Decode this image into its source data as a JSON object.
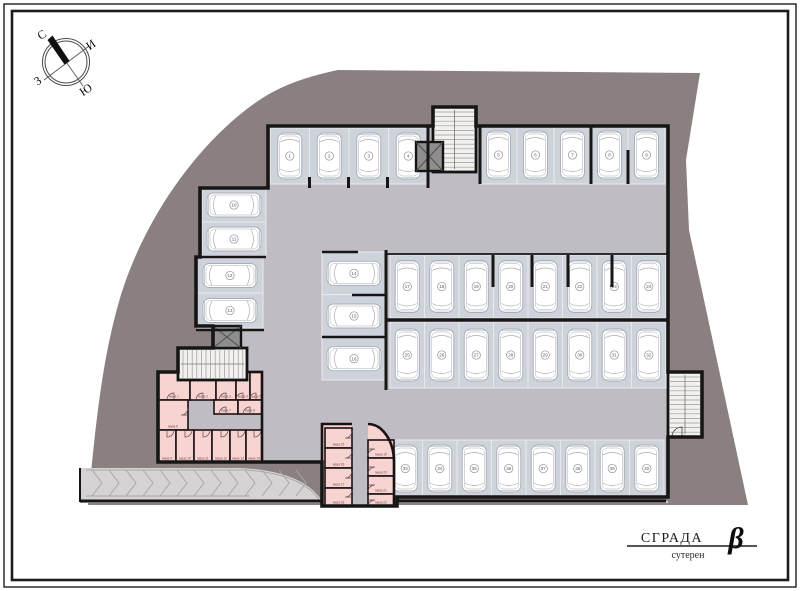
{
  "drawing": {
    "compass": {
      "north": "С",
      "east": "И",
      "west": "З",
      "south": "Ю"
    },
    "title_block": {
      "building_label": "СГРАДА",
      "building_symbol": "β",
      "floor_label": "сутерен"
    },
    "colors": {
      "site": "#8a807f",
      "floor": "#bfbdc3",
      "stall": "#ced2db",
      "road": "#d5d3d4",
      "road_mark": "#a9a7a8",
      "storage": "#f7d3d1",
      "storage_wall": "#1a1212",
      "wall": "#161616",
      "stairs": "#f2f1ef",
      "elevator": "#8f8d8e",
      "car_fill": "#ffffff",
      "car_outline": "#a8adb6",
      "number_ink": "#555b63"
    },
    "parking": {
      "groups": [
        {
          "id": "top-left",
          "numbers": [
            1,
            2,
            3,
            4
          ]
        },
        {
          "id": "top-right",
          "numbers": [
            5,
            6,
            7,
            8,
            9
          ]
        },
        {
          "id": "west-upper",
          "numbers": [
            10,
            11
          ]
        },
        {
          "id": "west-lower",
          "numbers": [
            12,
            13
          ]
        },
        {
          "id": "mid-column",
          "numbers": [
            14,
            15,
            16
          ]
        },
        {
          "id": "center-north",
          "numbers": [
            17,
            18,
            19,
            20,
            21,
            22,
            23,
            24
          ]
        },
        {
          "id": "center-south",
          "numbers": [
            25,
            26,
            27,
            28,
            29,
            30,
            31,
            32
          ]
        },
        {
          "id": "south-row",
          "numbers": [
            33,
            34,
            35,
            36,
            37,
            38,
            39,
            40
          ]
        }
      ]
    },
    "storage": {
      "block1_rooms": [
        "маза 1",
        "маза 2",
        "маза 3",
        "маза 4",
        "маза 5",
        "маза 6",
        "маза 7",
        "маза 8",
        "маза 9",
        "маза 10",
        "маза 11",
        "маза 12",
        "маза 13",
        "маза 14"
      ],
      "block2_rooms": [
        "маза 15",
        "маза 16",
        "маза 17",
        "маза 18",
        "маза 19",
        "маза 20",
        "маза 21",
        "маза 22"
      ]
    }
  }
}
